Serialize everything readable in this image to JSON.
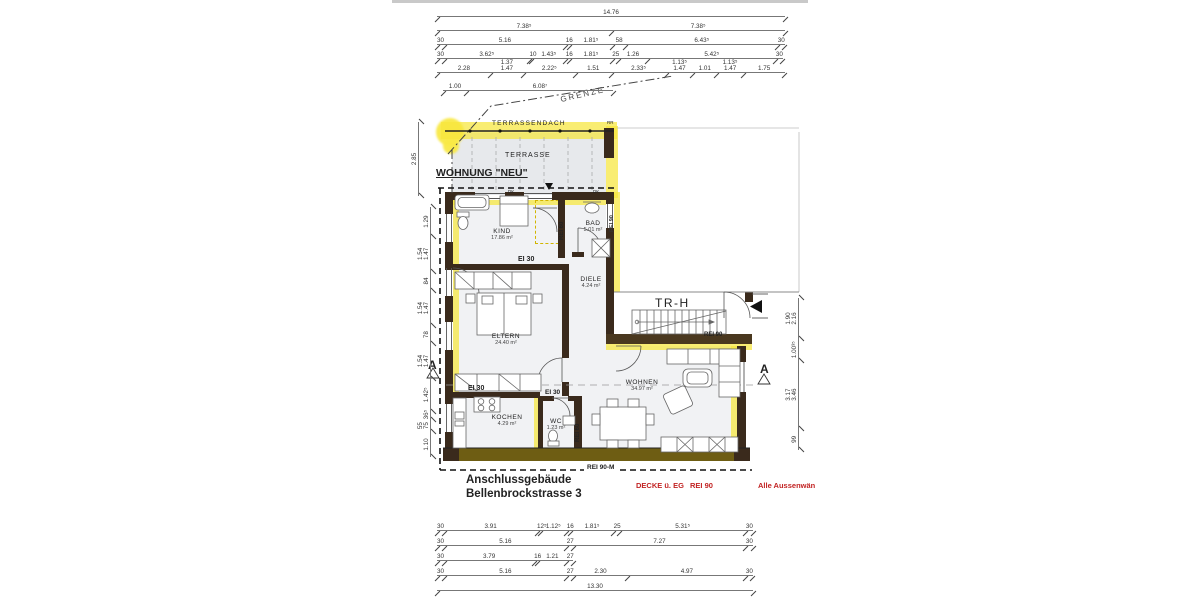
{
  "annotations": {
    "wohnung_neu": "WOHNUNG \"NEU\"",
    "terrassendach": "TERRASSENDACH",
    "terrasse": "TERRASSE",
    "grenze": "GRENZE",
    "rr": "RR",
    "dk1": "DK",
    "dk2": "DK",
    "trh": "TR-H",
    "ei30_a": "EI 30",
    "ei30_b": "EI 30",
    "ei30_c": "EI 30",
    "rei60_a": "REI 60",
    "rei60_b": "REI 60",
    "rei90_wall": "REI 90",
    "rei90_stairs": "REI 90",
    "rei90m": "REI 90-M",
    "section_a_left": "A",
    "section_a_right": "A",
    "title_line1": "Anschlussgebäude",
    "title_line2": "Bellenbrockstrasse 3",
    "red_decke": "DECKE ü. EG",
    "red_rei": "REI 90",
    "red_aussen": "Alle Aussenwän"
  },
  "rooms": {
    "kind": {
      "name": "KIND",
      "area": "17.86 m²"
    },
    "bad": {
      "name": "BAD",
      "area": "5.01 m²"
    },
    "diele": {
      "name": "DIELE",
      "area": "4.24 m²"
    },
    "eltern": {
      "name": "ELTERN",
      "area": "24.40 m²"
    },
    "kochen": {
      "name": "KOCHEN",
      "area": "4.29 m²"
    },
    "wc": {
      "name": "WC",
      "area": "1.23 m²"
    },
    "wohnen": {
      "name": "WOHNEN",
      "area": "34.97 m²"
    }
  },
  "colors": {
    "wall": "#3a2a1c",
    "highlight": "#f6e63c",
    "terrace_fill": "#e7e9ec",
    "room_fill": "#f1f2f4",
    "red_text": "#c22323"
  },
  "dim_blocks": [
    {
      "name": "top-dims",
      "orient": "h",
      "x": 437,
      "y": 6,
      "length": 348,
      "row_gap": 14,
      "total": 14.76,
      "rows": [
        [
          {
            "label": "14.76",
            "w": 14.76
          }
        ],
        [
          {
            "label": "7.38⁵",
            "w": 7.385
          },
          {
            "label": "7.38⁵",
            "w": 7.385
          }
        ],
        [
          {
            "label": "30",
            "w": 0.3
          },
          {
            "label": "5.16",
            "w": 5.16
          },
          {
            "label": "16",
            "w": 0.16
          },
          {
            "label": "1.81⁵",
            "w": 1.815
          },
          {
            "label": "58",
            "w": 0.58
          },
          {
            "label": "6.43⁵",
            "w": 6.435
          },
          {
            "label": "30",
            "w": 0.3
          }
        ],
        [
          {
            "label": "30",
            "w": 0.3
          },
          {
            "label": "3.62⁵",
            "w": 3.625
          },
          {
            "label": "10",
            "w": 0.1
          },
          {
            "label": "1.43⁵",
            "w": 1.435
          },
          {
            "label": "16",
            "w": 0.16
          },
          {
            "label": "1.81⁵",
            "w": 1.815
          },
          {
            "label": "25",
            "w": 0.25
          },
          {
            "label": "1.26",
            "w": 1.26
          },
          {
            "label": "5.42⁵",
            "w": 5.425
          },
          {
            "label": "30",
            "w": 0.3
          }
        ],
        [
          {
            "label": "2.28",
            "w": 2.28
          },
          {
            "label": "1.37\n1.47",
            "w": 1.37
          },
          {
            "label": "2.22⁵",
            "w": 2.225
          },
          {
            "label": "1.51",
            "w": 1.51
          },
          {
            "label": "2.33⁵",
            "w": 2.335
          },
          {
            "label": "1.13⁵\n1.47",
            "w": 1.135
          },
          {
            "label": "1.01",
            "w": 1.01
          },
          {
            "label": "1.13⁵\n1.47",
            "w": 1.135
          },
          {
            "label": "1.75",
            "w": 1.75
          }
        ]
      ]
    },
    {
      "name": "grenze-dims",
      "orient": "h",
      "x": 443,
      "y": 80,
      "length": 170,
      "row_gap": 14,
      "total": 7.087,
      "rows": [
        [
          {
            "label": "1.00",
            "w": 1.0
          },
          {
            "label": "6.08⁷",
            "w": 6.087
          }
        ]
      ]
    },
    {
      "name": "bottom-dims",
      "orient": "h",
      "x": 437,
      "y": 520,
      "length": 316,
      "row_gap": 15,
      "total": 13.3,
      "rows": [
        [
          {
            "label": "30",
            "w": 0.3
          },
          {
            "label": "3.91",
            "w": 3.91
          },
          {
            "label": "12⁵",
            "w": 0.125
          },
          {
            "label": "1.12⁵",
            "w": 1.125
          },
          {
            "label": "16",
            "w": 0.16
          },
          {
            "label": "1.81⁵",
            "w": 1.815
          },
          {
            "label": "25",
            "w": 0.25
          },
          {
            "label": "5.31⁵",
            "w": 5.315
          },
          {
            "label": "30",
            "w": 0.3
          }
        ],
        [
          {
            "label": "30",
            "w": 0.3
          },
          {
            "label": "5.16",
            "w": 5.16
          },
          {
            "label": "27",
            "w": 0.27
          },
          {
            "label": "7.27",
            "w": 7.27
          },
          {
            "label": "30",
            "w": 0.3
          }
        ],
        [
          {
            "label": "30",
            "w": 0.3
          },
          {
            "label": "3.79",
            "w": 3.79
          },
          {
            "label": "16",
            "w": 0.16
          },
          {
            "label": "1.21",
            "w": 1.21
          },
          {
            "label": "27",
            "w": 0.27
          }
        ],
        [
          {
            "label": "30",
            "w": 0.3
          },
          {
            "label": "5.16",
            "w": 5.16
          },
          {
            "label": "27",
            "w": 0.27
          },
          {
            "label": "2.30",
            "w": 2.3
          },
          {
            "label": "4.97",
            "w": 4.97
          },
          {
            "label": "30",
            "w": 0.3
          }
        ],
        [
          {
            "label": "13.30",
            "w": 13.3
          }
        ]
      ]
    },
    {
      "name": "terrace-height-dim",
      "orient": "v",
      "x": 408,
      "y": 122,
      "length": 74,
      "row_gap": 14,
      "total": 2.85,
      "rows": [
        [
          {
            "label": "2.85",
            "w": 2.85
          }
        ]
      ]
    },
    {
      "name": "left-dims",
      "orient": "v",
      "x": 420,
      "y": 207,
      "length": 250,
      "row_gap": 14,
      "total": 10.965,
      "rows": [
        [
          {
            "label": "1.29",
            "w": 1.29
          },
          {
            "label": "1.54\n1.47",
            "w": 1.54
          },
          {
            "label": "84",
            "w": 0.84
          },
          {
            "label": "1.54\n1.47",
            "w": 1.54
          },
          {
            "label": "78",
            "w": 0.78
          },
          {
            "label": "1.54\n1.47",
            "w": 1.54
          },
          {
            "label": "1.42⁵",
            "w": 1.425
          },
          {
            "label": "36⁵",
            "w": 0.365
          },
          {
            "label": "55\n75",
            "w": 0.55
          },
          {
            "label": "1.10",
            "w": 1.1
          }
        ]
      ]
    },
    {
      "name": "right-dims",
      "orient": "v",
      "x": 788,
      "y": 298,
      "length": 152,
      "row_gap": 14,
      "total": 7.0635,
      "rows": [
        [
          {
            "label": "1.90\n2.16",
            "w": 1.9
          },
          {
            "label": "1.00³⁵",
            "w": 1.0035
          },
          {
            "label": "3.17\n3.46",
            "w": 3.17
          },
          {
            "label": "99",
            "w": 0.99
          }
        ]
      ]
    }
  ]
}
